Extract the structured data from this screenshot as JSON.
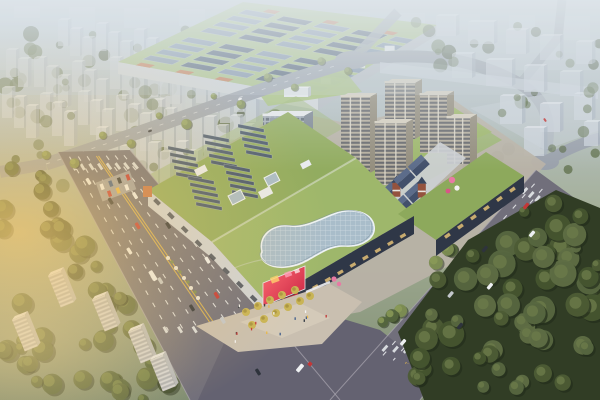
{
  "meta": {
    "title": "Aerial rendering of a mixed-use commercial complex",
    "description": "Daytime bird's-eye architectural rendering: a large shopping mall with planted green roofs, rooftop solar arrays and a curved glass skylight, an office tower, beige residential high-rises, a European-style retail street with slate pitched roofs and red brick towers, a green-roofed industrial hall behind, hazy residential slab blocks on the horizon, wide tree-lined avenues with traffic meeting at an intersection by an entrance plaza with an LED screen, dense dark woodland in the lower right, and warm sunlight glare from the left."
  },
  "scene": {
    "regions": [
      {
        "name": "far-city-band",
        "label": "Hazy city skyline band"
      },
      {
        "name": "tl-residential-blocks",
        "label": "Hazy residential slab rows (upper left)"
      },
      {
        "name": "industrial-hall",
        "label": "Green-roof industrial hall with solar strips"
      },
      {
        "name": "far-roads",
        "label": "Secondary roads and junctions"
      },
      {
        "name": "tr-residential-blocks",
        "label": "Hazy residential blocks (upper right)"
      },
      {
        "name": "complex-plinth",
        "label": "Complex sidewalks and lawns"
      },
      {
        "name": "main-avenue",
        "label": "Main avenue with lane markings"
      },
      {
        "name": "east-road",
        "label": "East boulevard"
      },
      {
        "name": "junction",
        "label": "Road intersection"
      },
      {
        "name": "woodland",
        "label": "Dense dark woodland"
      },
      {
        "name": "mall-roof",
        "label": "Mall green roof with solar arrays"
      },
      {
        "name": "glass-skylight",
        "label": "Curved rooftop glass skylight"
      },
      {
        "name": "office-tower",
        "label": "Office tower"
      },
      {
        "name": "residential-towers",
        "label": "Beige residential towers"
      },
      {
        "name": "retail-street",
        "label": "European-style retail street"
      },
      {
        "name": "east-retail",
        "label": "Green-roof retail block"
      },
      {
        "name": "entrance-plaza",
        "label": "Entrance plaza with yellow trees"
      },
      {
        "name": "led-screen",
        "label": "Corner LED advertising screen"
      },
      {
        "name": "traffic",
        "label": "Cars and buses on roads"
      },
      {
        "name": "sun-glare",
        "label": "Warm sunlight glare from left"
      }
    ]
  },
  "colors": {
    "haze_top": "#bac6ce",
    "glare": "#f7c96e",
    "lawn": "#9cb573",
    "road": "#716f7b",
    "road_dark": "#646271",
    "road_far": "#9aa1ab",
    "lane_yellow": "#d8b152",
    "lane_white": "#eceff1",
    "sidewalk": "#b8b2a7",
    "plaza": "#c9bfb0",
    "plaza_light": "#cdd0d4",
    "tree_dark": "#3e4c2f",
    "tree_mid": "#54653d",
    "tree_light": "#6e7f4a",
    "tree_street": "#7c8d52",
    "tree_yellow": "#c8b455",
    "forest": "#313d25",
    "forest_blob": "#4d5c35",
    "slab_front": "#ccd3db",
    "slab_side": "#a9b3bf",
    "slab_top": "#e0e5ea",
    "factory_roof": "#a8c17e",
    "panel": "#47586f",
    "panel_light": "#7b8ea6",
    "factory_wall": "#d2d6d9",
    "factory_side": "#b7bdc3",
    "accent_orange": "#c8764b",
    "mall_roof": "#92ac60",
    "mall_roof_light": "#9eb76b",
    "retail_green": "#8da95c",
    "mall_wall": "#2f3747",
    "mall_wall_light": "#cfd3d8",
    "storefront": "#d9b873",
    "skylight": "#a9bdca",
    "skylight_frame": "#edf2f5",
    "tower_front": "#b6af9f",
    "tower_side": "#948e7e",
    "tower_top": "#d5cfbf",
    "office_front": "#a6b0ba",
    "office_side": "#7e8894",
    "office_top": "#e6e9ec",
    "euro_roof": "#42506b",
    "euro_roof_light": "#5c6c8a",
    "brick": "#94523e",
    "led_a": "#ff5f72",
    "led_b": "#c41f40",
    "car_white": "#eef0f2",
    "car_dark": "#2e333c",
    "car_red": "#c23737",
    "car_blue": "#3e5c8c",
    "car_silver": "#c3c7cc",
    "balloon_pink": "#e87aa4"
  }
}
